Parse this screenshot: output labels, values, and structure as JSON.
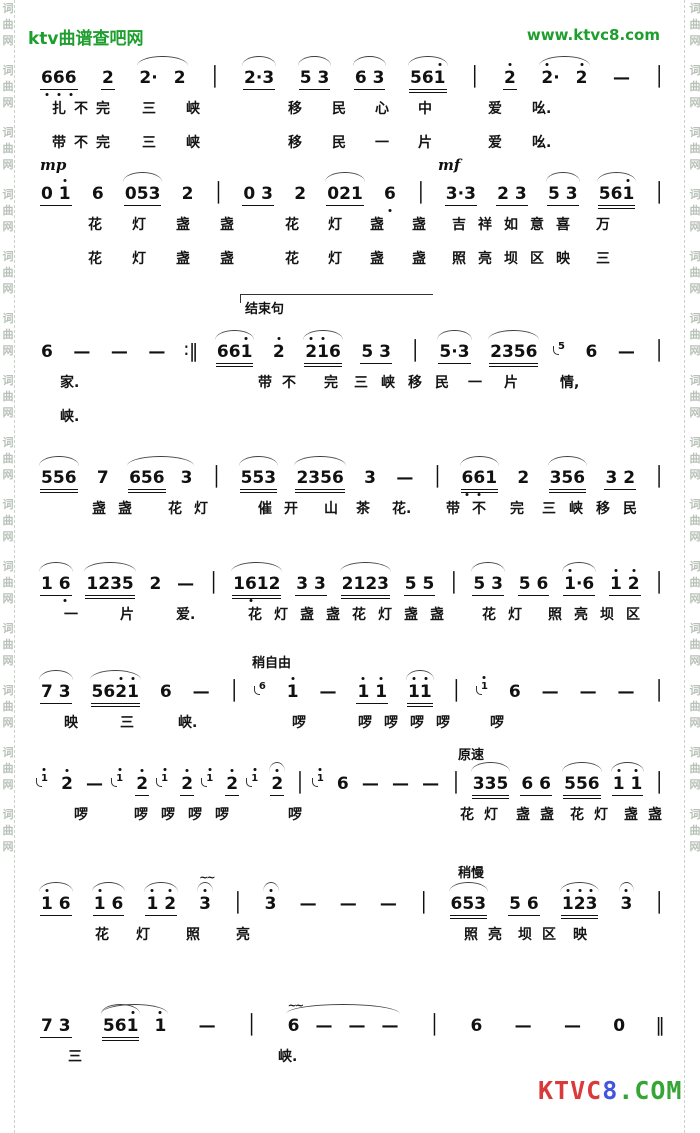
{
  "header": {
    "site_name": "ktv曲谱查吧网",
    "site_url": "www.ktvc8.com",
    "color": "#1e9e2e"
  },
  "border": {
    "chars": [
      "词",
      "曲",
      "网"
    ],
    "repeat": 14,
    "color": "#b9c2b9"
  },
  "footer_logo": {
    "segments": [
      {
        "t": "KTVC",
        "color": "#d93a3a"
      },
      {
        "t": "8",
        "color": "#4455dd"
      },
      {
        "t": ".COM",
        "color": "#36a536"
      }
    ]
  },
  "systems": [
    {
      "tokens": [
        {
          "t": "666",
          "u": 1,
          "lo": "all"
        },
        {
          "t": "2",
          "u": 1
        },
        {
          "g": [
            {
              "t": "2·"
            },
            {
              "t": "2"
            }
          ],
          "slur": true
        },
        {
          "t": "│",
          "bar": true
        },
        {
          "t": "2·3",
          "u": 1,
          "slur": true
        },
        {
          "t": "5 3",
          "u": 1,
          "slur": true
        },
        {
          "t": "6 3",
          "u": 1,
          "slur": true
        },
        {
          "t": "561",
          "u": 2,
          "hi": [
            2
          ],
          "slur": true
        },
        {
          "t": "│",
          "bar": true
        },
        {
          "t": "2",
          "u": 1,
          "hi": [
            0
          ]
        },
        {
          "g": [
            {
              "t": "2·",
              "hi": [
                0
              ]
            },
            {
              "t": "2",
              "hi": [
                0
              ]
            }
          ],
          "slur": true
        },
        {
          "t": "—"
        },
        {
          "t": "│",
          "bar": true
        }
      ],
      "lyrics": [
        [
          {
            "t": "扎不完",
            "x": 12,
            "sp": 8
          },
          {
            "t": "三",
            "x": 102
          },
          {
            "t": "峡",
            "x": 146
          },
          {
            "t": "移",
            "x": 248
          },
          {
            "t": "民",
            "x": 292
          },
          {
            "t": "心",
            "x": 335
          },
          {
            "t": "中",
            "x": 378
          },
          {
            "t": "爱",
            "x": 448
          },
          {
            "t": "吆.",
            "x": 492
          }
        ],
        [
          {
            "t": "带不完",
            "x": 12,
            "sp": 8
          },
          {
            "t": "三",
            "x": 102
          },
          {
            "t": "峡",
            "x": 146
          },
          {
            "t": "移",
            "x": 248
          },
          {
            "t": "民",
            "x": 292
          },
          {
            "t": "一",
            "x": 335
          },
          {
            "t": "片",
            "x": 378
          },
          {
            "t": "爱",
            "x": 448
          },
          {
            "t": "吆.",
            "x": 492
          }
        ]
      ]
    },
    {
      "markings": [
        {
          "t": "mp",
          "x": 0,
          "dyn": true
        },
        {
          "t": "mf",
          "x": 398,
          "dyn": true
        }
      ],
      "tokens": [
        {
          "t": "0 1",
          "u": 1,
          "hi": [
            2
          ]
        },
        {
          "t": "6"
        },
        {
          "t": "053",
          "u": 1,
          "slur": true
        },
        {
          "t": "2"
        },
        {
          "t": "│",
          "bar": true
        },
        {
          "t": "0 3",
          "u": 1
        },
        {
          "t": "2"
        },
        {
          "t": "021",
          "u": 1,
          "slur": true
        },
        {
          "t": "6",
          "lo": [
            0
          ]
        },
        {
          "t": "│",
          "bar": true
        },
        {
          "t": "3·3",
          "u": 1
        },
        {
          "t": "2 3",
          "u": 1
        },
        {
          "t": "5 3",
          "u": 1,
          "slur": true
        },
        {
          "t": "561",
          "u": 2,
          "hi": [
            2
          ],
          "slur": true
        },
        {
          "t": "│",
          "bar": true
        }
      ],
      "lyrics": [
        [
          {
            "t": "花",
            "x": 48
          },
          {
            "t": "灯",
            "x": 92
          },
          {
            "t": "盏",
            "x": 136
          },
          {
            "t": "盏",
            "x": 180
          },
          {
            "t": "花",
            "x": 245
          },
          {
            "t": "灯",
            "x": 288
          },
          {
            "t": "盏",
            "x": 330
          },
          {
            "t": "盏",
            "x": 372
          },
          {
            "t": "吉祥如意喜",
            "x": 412,
            "sp": 12
          },
          {
            "t": "万",
            "x": 556
          }
        ],
        [
          {
            "t": "花",
            "x": 48
          },
          {
            "t": "灯",
            "x": 92
          },
          {
            "t": "盏",
            "x": 136
          },
          {
            "t": "盏",
            "x": 180
          },
          {
            "t": "花",
            "x": 245
          },
          {
            "t": "灯",
            "x": 288
          },
          {
            "t": "盏",
            "x": 330
          },
          {
            "t": "盏",
            "x": 372
          },
          {
            "t": "照亮坝区映",
            "x": 412,
            "sp": 12
          },
          {
            "t": "三",
            "x": 556
          }
        ]
      ]
    },
    {
      "bracket": {
        "x": 200,
        "w": 192,
        "label": "结束句"
      },
      "tokens": [
        {
          "t": "6"
        },
        {
          "t": "—"
        },
        {
          "t": "—"
        },
        {
          "t": "—"
        },
        {
          "t": "∶‖",
          "bar": true
        },
        {
          "t": "661",
          "u": 2,
          "hi": [
            2
          ],
          "slur": true
        },
        {
          "t": "2",
          "hi": [
            0
          ]
        },
        {
          "t": "216",
          "u": 2,
          "hi": [
            0,
            1
          ],
          "slur": true
        },
        {
          "t": "5 3",
          "u": 1
        },
        {
          "t": "│",
          "bar": true
        },
        {
          "t": "5·3",
          "u": 1,
          "slur": true
        },
        {
          "t": "2356",
          "u": 2,
          "slur": true
        },
        {
          "t": "5",
          "grace": true
        },
        {
          "t": "6"
        },
        {
          "t": "—"
        },
        {
          "t": "│",
          "bar": true
        }
      ],
      "lyrics": [
        [
          {
            "t": "家.",
            "x": 20
          },
          {
            "t": "带不",
            "x": 218,
            "sp": 10
          },
          {
            "t": "完",
            "x": 284
          },
          {
            "t": "三峡移民",
            "x": 314,
            "sp": 13
          },
          {
            "t": "一",
            "x": 428
          },
          {
            "t": "片",
            "x": 464
          },
          {
            "t": "情,",
            "x": 520
          }
        ],
        [
          {
            "t": "峡.",
            "x": 20
          }
        ]
      ]
    },
    {
      "tokens": [
        {
          "t": "556",
          "u": 2,
          "slur": true
        },
        {
          "t": "7"
        },
        {
          "g": [
            {
              "t": "656",
              "u": 2
            },
            {
              "t": "3"
            }
          ],
          "slur": true
        },
        {
          "t": "│",
          "bar": true
        },
        {
          "t": "553",
          "u": 2,
          "slur": true
        },
        {
          "t": "2356",
          "u": 2,
          "slur": true
        },
        {
          "t": "3"
        },
        {
          "t": "—"
        },
        {
          "t": "│",
          "bar": true
        },
        {
          "t": "661",
          "u": 2,
          "lo": [
            0,
            1
          ],
          "slur": true
        },
        {
          "t": "2"
        },
        {
          "t": "356",
          "u": 2,
          "slur": true
        },
        {
          "t": "3 2",
          "u": 1
        },
        {
          "t": "│",
          "bar": true
        }
      ],
      "lyrics": [
        [
          {
            "t": "盏盏",
            "x": 52,
            "sp": 12
          },
          {
            "t": "花灯",
            "x": 128,
            "sp": 12
          },
          {
            "t": "催开",
            "x": 218,
            "sp": 12
          },
          {
            "t": "山",
            "x": 284
          },
          {
            "t": "茶",
            "x": 316
          },
          {
            "t": "花.",
            "x": 352
          },
          {
            "t": "带不",
            "x": 406,
            "sp": 12
          },
          {
            "t": "完",
            "x": 470
          },
          {
            "t": "三峡移民",
            "x": 502,
            "sp": 13
          }
        ]
      ]
    },
    {
      "tokens": [
        {
          "t": "1 6",
          "u": 1,
          "lo": [
            2
          ],
          "slur": true
        },
        {
          "t": "1235",
          "u": 2,
          "slur": true
        },
        {
          "t": "2"
        },
        {
          "t": "—"
        },
        {
          "t": "│",
          "bar": true
        },
        {
          "t": "1612",
          "u": 2,
          "lo": [
            1
          ],
          "slur": true
        },
        {
          "t": "3 3",
          "u": 1
        },
        {
          "t": "2123",
          "u": 2,
          "slur": true
        },
        {
          "t": "5 5",
          "u": 1
        },
        {
          "t": "│",
          "bar": true
        },
        {
          "t": "5 3",
          "u": 1,
          "slur": true
        },
        {
          "t": "5 6",
          "u": 1
        },
        {
          "t": "1·6",
          "u": 1,
          "hi": [
            0
          ],
          "slur": true
        },
        {
          "t": "1 2",
          "u": 1,
          "hi": [
            0,
            2
          ]
        },
        {
          "t": "│",
          "bar": true
        }
      ],
      "lyrics": [
        [
          {
            "t": "一",
            "x": 24
          },
          {
            "t": "片",
            "x": 80
          },
          {
            "t": "爱.",
            "x": 136
          },
          {
            "t": "花灯盏盏花灯盏盏",
            "x": 208,
            "sp": 12
          },
          {
            "t": "花灯",
            "x": 442,
            "sp": 12
          },
          {
            "t": "照亮坝区",
            "x": 508,
            "sp": 12
          }
        ]
      ]
    },
    {
      "markings": [
        {
          "t": "稍自由",
          "x": 212
        }
      ],
      "tokens": [
        {
          "t": "7 3",
          "u": 1,
          "slur": true
        },
        {
          "t": "5621",
          "u": 2,
          "hi": [
            2,
            3
          ],
          "slur": true
        },
        {
          "t": "6"
        },
        {
          "t": "—"
        },
        {
          "t": "│",
          "bar": true
        },
        {
          "t": "6",
          "grace": true
        },
        {
          "t": "1",
          "hi": [
            0
          ]
        },
        {
          "t": "—"
        },
        {
          "t": "1 1",
          "u": 1,
          "hi": [
            0,
            2
          ]
        },
        {
          "t": "11",
          "u": 2,
          "hi": [
            0,
            1
          ],
          "slur": true
        },
        {
          "t": "│",
          "bar": true
        },
        {
          "t": "1",
          "grace": true,
          "hi": [
            0
          ]
        },
        {
          "t": "6"
        },
        {
          "t": "—"
        },
        {
          "t": "—"
        },
        {
          "t": "—"
        },
        {
          "t": "│",
          "bar": true
        }
      ],
      "lyrics": [
        [
          {
            "t": "映",
            "x": 24
          },
          {
            "t": "三",
            "x": 80
          },
          {
            "t": "峡.",
            "x": 138
          },
          {
            "t": "啰",
            "x": 252
          },
          {
            "t": "啰啰啰啰",
            "x": 318,
            "sp": 12
          },
          {
            "t": "啰",
            "x": 450
          }
        ]
      ]
    },
    {
      "markings": [
        {
          "t": "原速",
          "x": 418
        }
      ],
      "tokens": [
        {
          "t": "1",
          "grace": true,
          "hi": [
            0
          ]
        },
        {
          "t": "2",
          "hi": [
            0
          ]
        },
        {
          "t": "—"
        },
        {
          "t": "1",
          "grace": true,
          "hi": [
            0
          ]
        },
        {
          "t": "2",
          "u": 1,
          "hi": [
            0
          ]
        },
        {
          "t": "1",
          "grace": true,
          "hi": [
            0
          ]
        },
        {
          "t": "2",
          "u": 1,
          "hi": [
            0
          ]
        },
        {
          "t": "1",
          "grace": true,
          "hi": [
            0
          ]
        },
        {
          "t": "2",
          "u": 1,
          "hi": [
            0
          ]
        },
        {
          "t": "1",
          "grace": true,
          "hi": [
            0
          ]
        },
        {
          "t": "2",
          "u": 1,
          "hi": [
            0
          ],
          "slur": true
        },
        {
          "t": "│",
          "bar": true
        },
        {
          "t": "1",
          "grace": true,
          "hi": [
            0
          ]
        },
        {
          "t": "6"
        },
        {
          "t": "—"
        },
        {
          "t": "—"
        },
        {
          "t": "—"
        },
        {
          "t": "│",
          "bar": true
        },
        {
          "t": "335",
          "u": 2,
          "slur": true
        },
        {
          "t": "6 6",
          "u": 1
        },
        {
          "t": "556",
          "u": 2,
          "slur": true
        },
        {
          "t": "1 1",
          "u": 1,
          "hi": [
            0,
            2
          ],
          "slur": true
        },
        {
          "t": "│",
          "bar": true
        }
      ],
      "lyrics": [
        [
          {
            "t": "啰",
            "x": 34
          },
          {
            "t": "啰啰啰啰",
            "x": 94,
            "sp": 13
          },
          {
            "t": "啰",
            "x": 248
          },
          {
            "t": "花灯",
            "x": 420,
            "sp": 10
          },
          {
            "t": "盏盏",
            "x": 476,
            "sp": 10
          },
          {
            "t": "花灯",
            "x": 530,
            "sp": 10
          },
          {
            "t": "盏盏",
            "x": 584,
            "sp": 10
          }
        ]
      ]
    },
    {
      "markings": [
        {
          "t": "稍慢",
          "x": 418
        }
      ],
      "tokens": [
        {
          "t": "1 6",
          "u": 1,
          "hi": [
            0
          ],
          "slur": true
        },
        {
          "t": "1 6",
          "u": 1,
          "hi": [
            0
          ],
          "slur": true
        },
        {
          "t": "1 2",
          "u": 1,
          "hi": [
            0,
            2
          ],
          "slur": true
        },
        {
          "t": "3",
          "hi": [
            0
          ],
          "mord": "~~",
          "slur": true
        },
        {
          "t": "│",
          "bar": true
        },
        {
          "t": "3",
          "hi": [
            0
          ],
          "slur": true
        },
        {
          "t": "—"
        },
        {
          "t": "—"
        },
        {
          "t": "—"
        },
        {
          "t": "│",
          "bar": true
        },
        {
          "t": "653",
          "u": 2,
          "slur": true
        },
        {
          "t": "5 6",
          "u": 1
        },
        {
          "t": "123",
          "u": 2,
          "hi": "all",
          "slur": true
        },
        {
          "t": "3",
          "hi": [
            0
          ],
          "slur": true
        },
        {
          "t": "│",
          "bar": true
        }
      ],
      "lyrics": [
        [
          {
            "t": "花",
            "x": 55
          },
          {
            "t": "灯",
            "x": 96
          },
          {
            "t": "照",
            "x": 146
          },
          {
            "t": "亮",
            "x": 196
          },
          {
            "t": "照亮",
            "x": 424,
            "sp": 10
          },
          {
            "t": "坝区",
            "x": 478,
            "sp": 10
          },
          {
            "t": "映",
            "x": 533
          }
        ]
      ]
    },
    {
      "tokens": [
        {
          "t": "7 3",
          "u": 1
        },
        {
          "g": [
            {
              "t": "561",
              "u": 2,
              "hi": [
                2
              ],
              "slur": true
            },
            {
              "t": "1",
              "hi": [
                0
              ]
            }
          ],
          "slur": true
        },
        {
          "t": "—"
        },
        {
          "t": "│",
          "bar": true
        },
        {
          "g": [
            {
              "t": "6",
              "mord": "~~"
            },
            {
              "t": "—"
            },
            {
              "t": "—"
            },
            {
              "t": "—"
            }
          ],
          "slur": true
        },
        {
          "t": "│",
          "bar": true
        },
        {
          "t": "6"
        },
        {
          "t": "—"
        },
        {
          "t": "—"
        },
        {
          "t": "0"
        },
        {
          "t": "‖",
          "bar": true
        }
      ],
      "lyrics": [
        [
          {
            "t": "三",
            "x": 28
          },
          {
            "t": "峡.",
            "x": 238
          }
        ]
      ]
    }
  ]
}
